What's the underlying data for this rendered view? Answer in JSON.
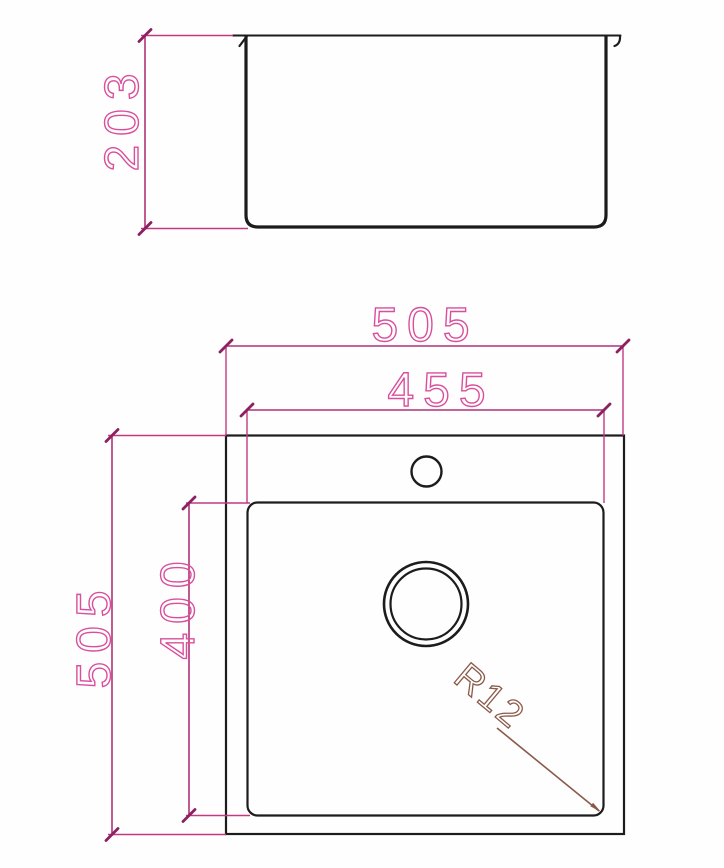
{
  "drawing": {
    "dimensions": {
      "side_depth": "203",
      "overall_width": "505",
      "bowl_width": "455",
      "overall_depth": "505",
      "bowl_depth": "400",
      "bowl_corner_radius": "R12"
    },
    "colors": {
      "geometry_line": "#1c1c1c",
      "dimension_line": "#b23078",
      "dimension_text": "#d94f9c",
      "radius_callout": "#8a5a49",
      "background": "#fefefe"
    }
  }
}
